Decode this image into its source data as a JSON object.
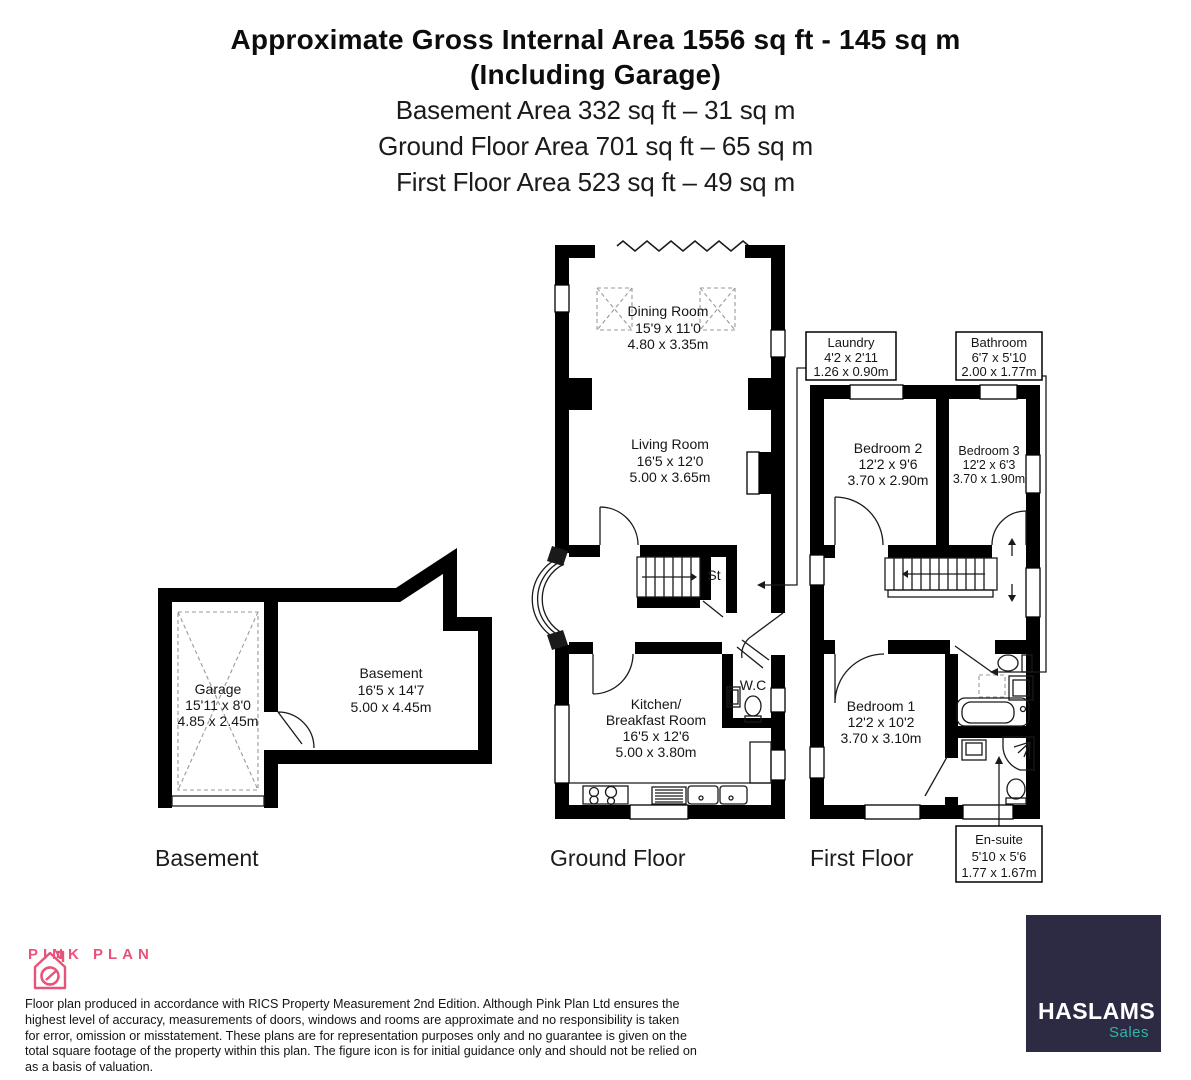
{
  "header": {
    "title_line1": "Approximate Gross Internal Area 1556 sq ft - 145 sq m",
    "title_line2": "(Including Garage)",
    "area_line1": "Basement Area 332 sq ft – 31 sq m",
    "area_line2": "Ground Floor Area 701 sq ft – 65 sq m",
    "area_line3": "First Floor Area 523 sq ft – 49 sq m"
  },
  "rooms": {
    "dining": {
      "name": "Dining Room",
      "imperial": "15'9 x 11'0",
      "metric": "4.80 x 3.35m"
    },
    "living": {
      "name": "Living Room",
      "imperial": "16'5 x 12'0",
      "metric": "5.00 x 3.65m"
    },
    "kitchen": {
      "name_line1": "Kitchen/",
      "name_line2": "Breakfast Room",
      "imperial": "16'5 x 12'6",
      "metric": "5.00 x 3.80m"
    },
    "wc": {
      "name": "W.C"
    },
    "store": {
      "name": "St"
    },
    "laundry": {
      "name": "Laundry",
      "imperial": "4'2 x 2'11",
      "metric": "1.26 x 0.90m"
    },
    "bathroom": {
      "name": "Bathroom",
      "imperial": "6'7 x 5'10",
      "metric": "2.00 x 1.77m"
    },
    "ensuite": {
      "name": "En-suite",
      "imperial": "5'10 x 5'6",
      "metric": "1.77 x 1.67m"
    },
    "bedroom1": {
      "name": "Bedroom 1",
      "imperial": "12'2 x 10'2",
      "metric": "3.70 x 3.10m"
    },
    "bedroom2": {
      "name": "Bedroom 2",
      "imperial": "12'2 x 9'6",
      "metric": "3.70 x 2.90m"
    },
    "bedroom3": {
      "name": "Bedroom 3",
      "imperial": "12'2 x 6'3",
      "metric": "3.70 x 1.90m"
    },
    "garage": {
      "name": "Garage",
      "imperial": "15'11 x 8'0",
      "metric": "4.85 x 2.45m"
    },
    "basement": {
      "name": "Basement",
      "imperial": "16'5 x 14'7",
      "metric": "5.00 x 4.45m"
    }
  },
  "floor_labels": {
    "basement": "Basement",
    "ground": "Ground Floor",
    "first": "First Floor"
  },
  "footer": {
    "brand_name": "PINK PLAN",
    "disclaimer": "Floor plan produced in accordance with RICS Property Measurement 2nd Edition. Although Pink Plan Ltd ensures the highest level of accuracy, measurements of doors, windows and rooms are approximate and no responsibility is taken for error, omission or misstatement. These plans are for representation purposes only and no guarantee is given on the total square footage of the property within this plan. The figure icon is for initial guidance only and should not be relied on as a basis of valuation."
  },
  "agency": {
    "name": "HASLAMS",
    "division": "Sales"
  },
  "colors": {
    "brand_pink": "#e8537a",
    "agency_navy": "#2d2a44",
    "agency_teal": "#2fb5a9",
    "wall_black": "#000000"
  }
}
